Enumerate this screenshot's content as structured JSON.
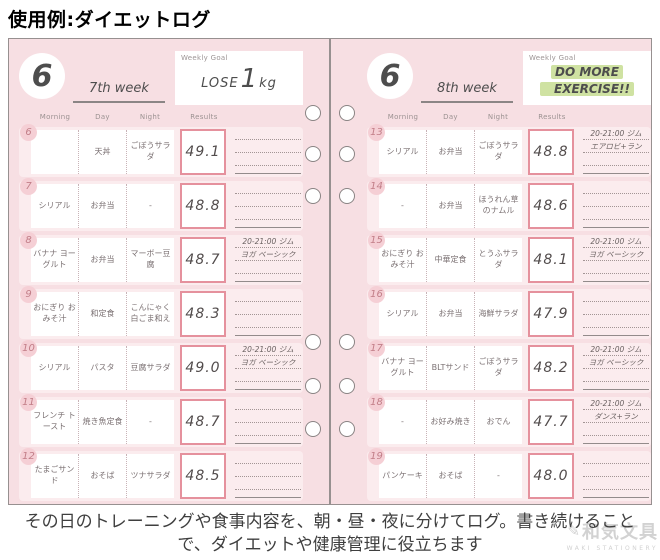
{
  "title": "使用例:ダイエットログ",
  "caption": "その日のトレーニングや食事内容を、朝・昼・夜に分けてログ。書き続けることで、ダイエットや健康管理に役立ちます",
  "watermark": {
    "name": "和気文具",
    "sub": "WAKI STATIONERY"
  },
  "column_headers": {
    "morning": "Morning",
    "day": "Day",
    "night": "Night",
    "results": "Results"
  },
  "colors": {
    "page_bg": "#f7dfe3",
    "row_band": "#fbecee",
    "results_border": "#e5919d",
    "date_circle": "#f5cfd5",
    "goal_highlight": "#cfe2a2"
  },
  "pages": [
    {
      "month": "6",
      "week": "7th week",
      "goal": {
        "label": "Weekly Goal",
        "text1": "LOSE",
        "text2": "1",
        "text3": "kg"
      },
      "rows": [
        {
          "date": "6",
          "morning": "",
          "day": "天丼",
          "night": "ごぼうサラダ",
          "results": "49.1",
          "note1": "",
          "note2": ""
        },
        {
          "date": "7",
          "morning": "シリアル",
          "day": "お弁当",
          "night": "-",
          "results": "48.8",
          "note1": "",
          "note2": ""
        },
        {
          "date": "8",
          "morning": "バナナ ヨーグルト",
          "day": "お弁当",
          "night": "マーボー豆腐",
          "results": "48.7",
          "note1": "20-21:00 ジム",
          "note2": "ヨガ ベーシック"
        },
        {
          "date": "9",
          "morning": "おにぎり おみそ汁",
          "day": "和定食",
          "night": "こんにゃく 白ごま和え",
          "results": "48.3",
          "note1": "",
          "note2": ""
        },
        {
          "date": "10",
          "morning": "シリアル",
          "day": "パスタ",
          "night": "豆腐サラダ",
          "results": "49.0",
          "note1": "20-21:00 ジム",
          "note2": "ヨガ ベーシック"
        },
        {
          "date": "11",
          "morning": "フレンチ トースト",
          "day": "焼き魚定食",
          "night": "-",
          "results": "48.7",
          "note1": "",
          "note2": ""
        },
        {
          "date": "12",
          "morning": "たまごサンド",
          "day": "おそば",
          "night": "ツナサラダ",
          "results": "48.5",
          "note1": "",
          "note2": ""
        }
      ]
    },
    {
      "month": "6",
      "week": "8th week",
      "goal": {
        "label": "Weekly Goal",
        "line1": "DO MORE",
        "line2": "EXERCISE!!"
      },
      "rows": [
        {
          "date": "13",
          "morning": "シリアル",
          "day": "お弁当",
          "night": "ごぼうサラダ",
          "results": "48.8",
          "note1": "20-21:00 ジム",
          "note2": "エアロビ+ラン"
        },
        {
          "date": "14",
          "morning": "-",
          "day": "お弁当",
          "night": "ほうれん草 のナムル",
          "results": "48.6",
          "note1": "",
          "note2": ""
        },
        {
          "date": "15",
          "morning": "おにぎり おみそ汁",
          "day": "中華定食",
          "night": "とうふサラダ",
          "results": "48.1",
          "note1": "20-21:00 ジム",
          "note2": "ヨガ ベーシック"
        },
        {
          "date": "16",
          "morning": "シリアル",
          "day": "お弁当",
          "night": "海鮮サラダ",
          "results": "47.9",
          "note1": "",
          "note2": ""
        },
        {
          "date": "17",
          "morning": "バナナ ヨーグルト",
          "day": "BLTサンド",
          "night": "ごぼうサラダ",
          "results": "48.2",
          "note1": "20-21:00 ジム",
          "note2": "ヨガ ベーシック"
        },
        {
          "date": "18",
          "morning": "-",
          "day": "お好み焼き",
          "night": "おでん",
          "results": "47.7",
          "note1": "20-21:00 ジム",
          "note2": "ダンス+ラン"
        },
        {
          "date": "19",
          "morning": "パンケーキ",
          "day": "おそば",
          "night": "-",
          "results": "48.0",
          "note1": "",
          "note2": ""
        }
      ]
    }
  ]
}
